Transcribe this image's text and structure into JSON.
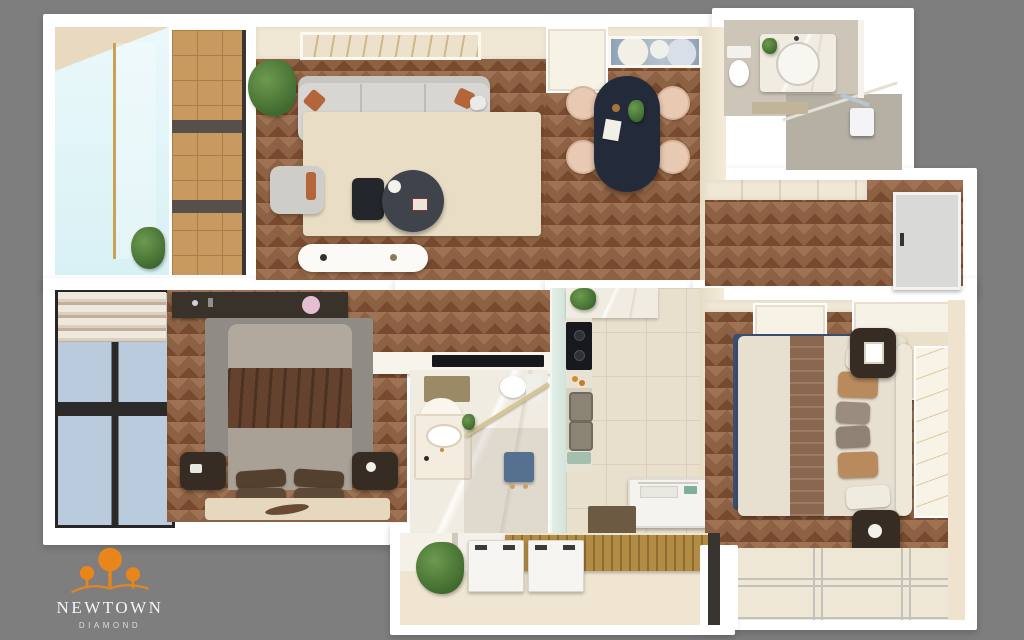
{
  "brand": {
    "name": "NEWTOWN",
    "subtitle": "DIAMOND",
    "logo_icon": "three-trees-hill-icon",
    "logo_color": "#E8861C"
  },
  "scene": {
    "type": "3d-apartment-floorplan-top-view",
    "background": "#7E7E7E"
  },
  "palette": {
    "wall": "#FFFFFF",
    "wall_face_cream": "#F0E8D5",
    "wood_floor": "#8D6143",
    "wood_floor_light": "#9E7252",
    "wood_floor_dark": "#77492E",
    "balcony_deck": "#C89A5F",
    "sky_glass": "#D8F1F5",
    "rug_cream": "#E9DDC5",
    "sofa_gray": "#D7D6D2",
    "accent_terracotta": "#B4653A",
    "dining_table_navy": "#232B3A",
    "chair_blush": "#E8C9B2",
    "bed_blanket_brown": "#64422D",
    "rug_navy": "#3C4F73",
    "tile_cream": "#E9DFCD",
    "glass_green": "#CFE2D8",
    "stool_blue": "#55718F",
    "furniture_dark": "#362C23"
  }
}
